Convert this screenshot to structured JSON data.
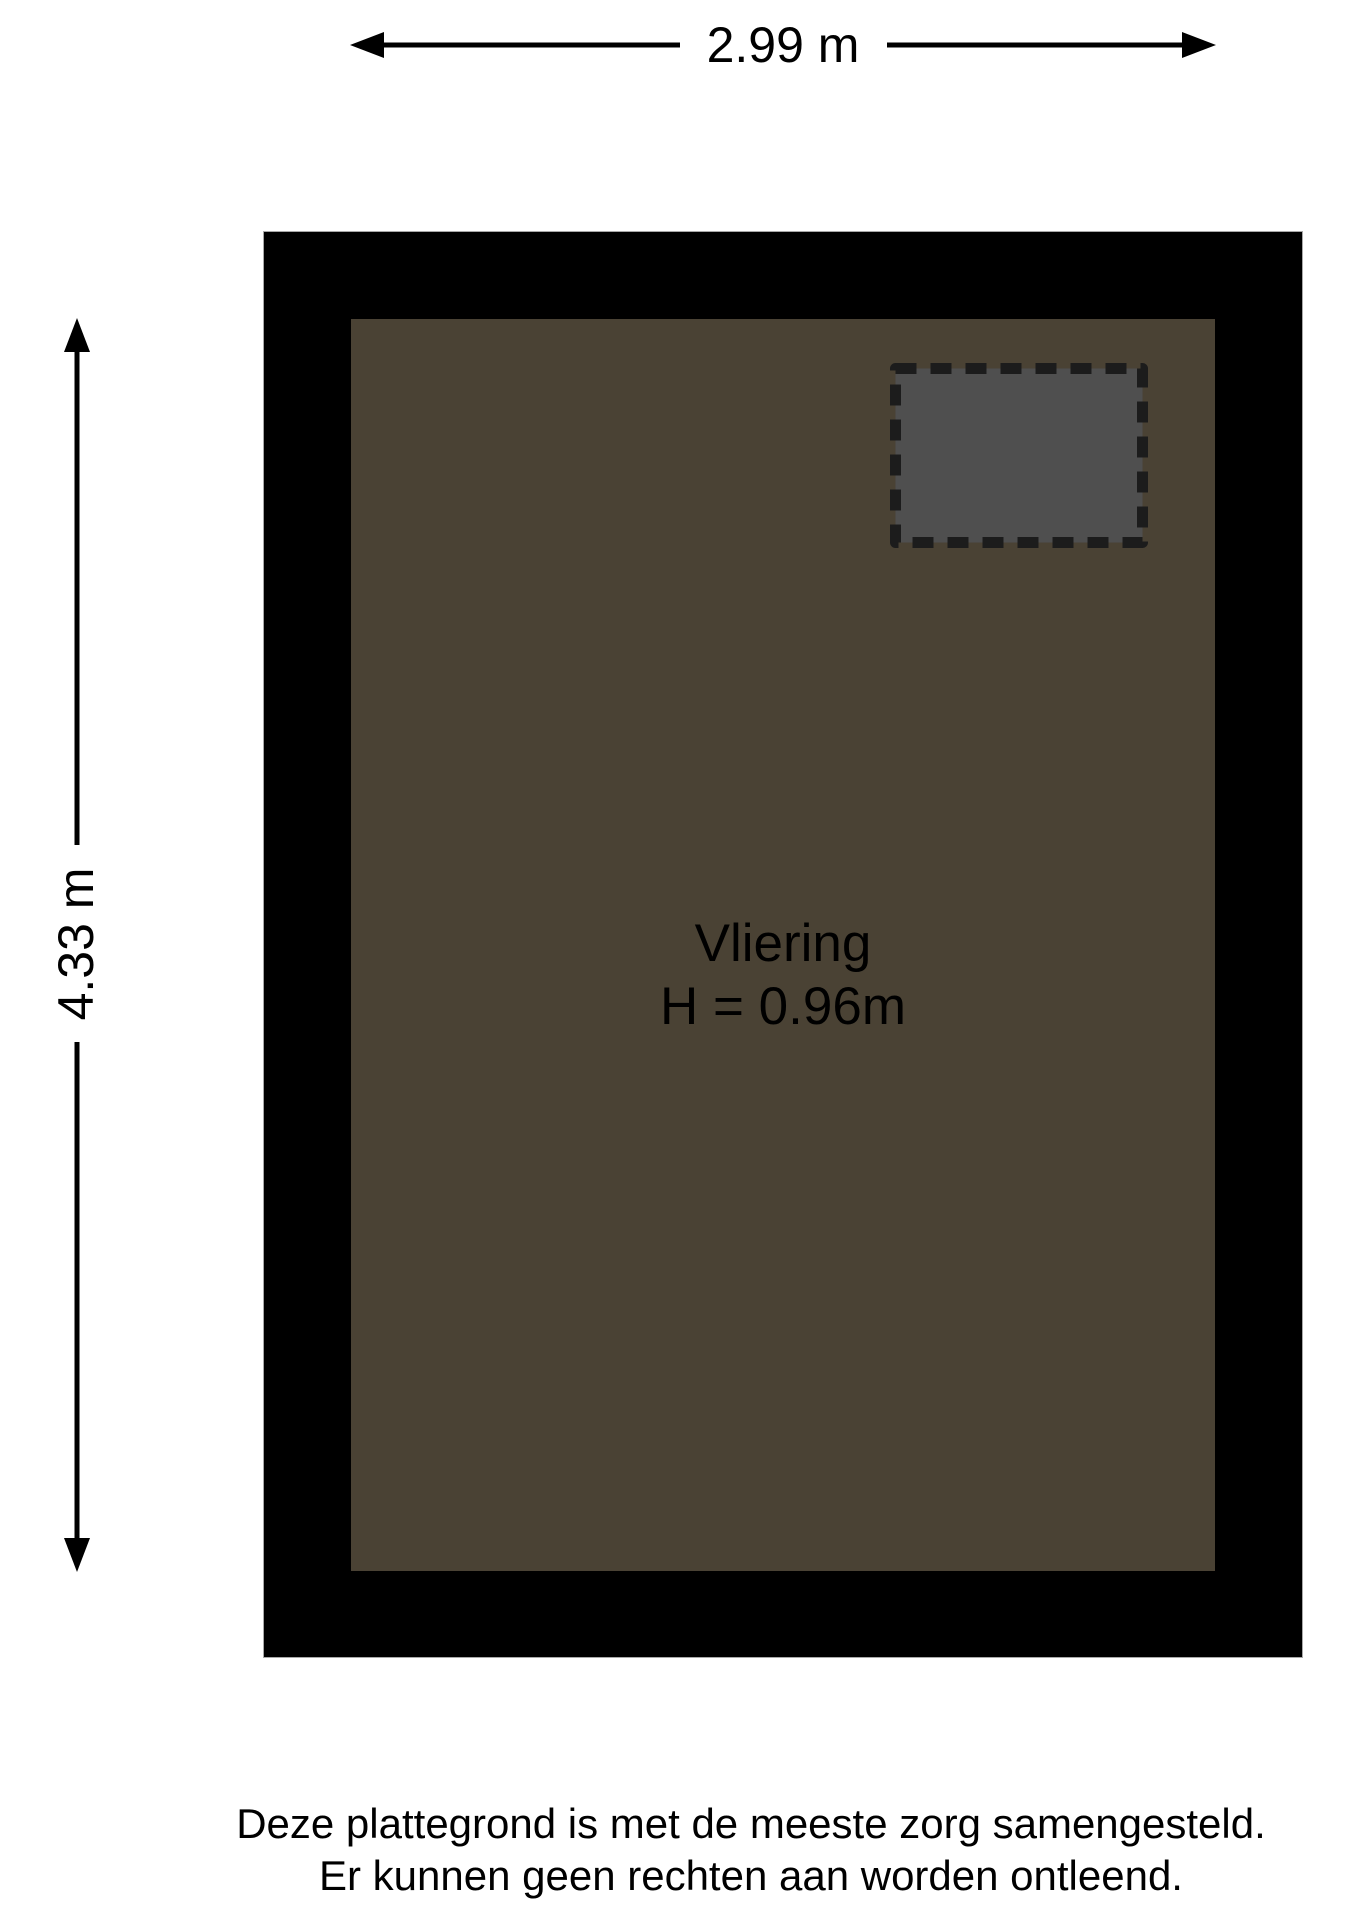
{
  "dim_width": {
    "label": "2.99 m"
  },
  "dim_height": {
    "label": "4.33 m"
  },
  "room": {
    "name": "Vliering",
    "height": "H = 0.96m"
  },
  "disclaimer": {
    "line1": "Deze plattegrond is met de meeste zorg samengesteld.",
    "line2": "Er kunnen geen rechten aan worden ontleend."
  },
  "colors": {
    "background": "#ffffff",
    "wall": "#000000",
    "floor": "#4a4234",
    "hatch_fill": "#4f4f4f",
    "hatch_border": "#1c1c1c",
    "text": "#000000"
  }
}
